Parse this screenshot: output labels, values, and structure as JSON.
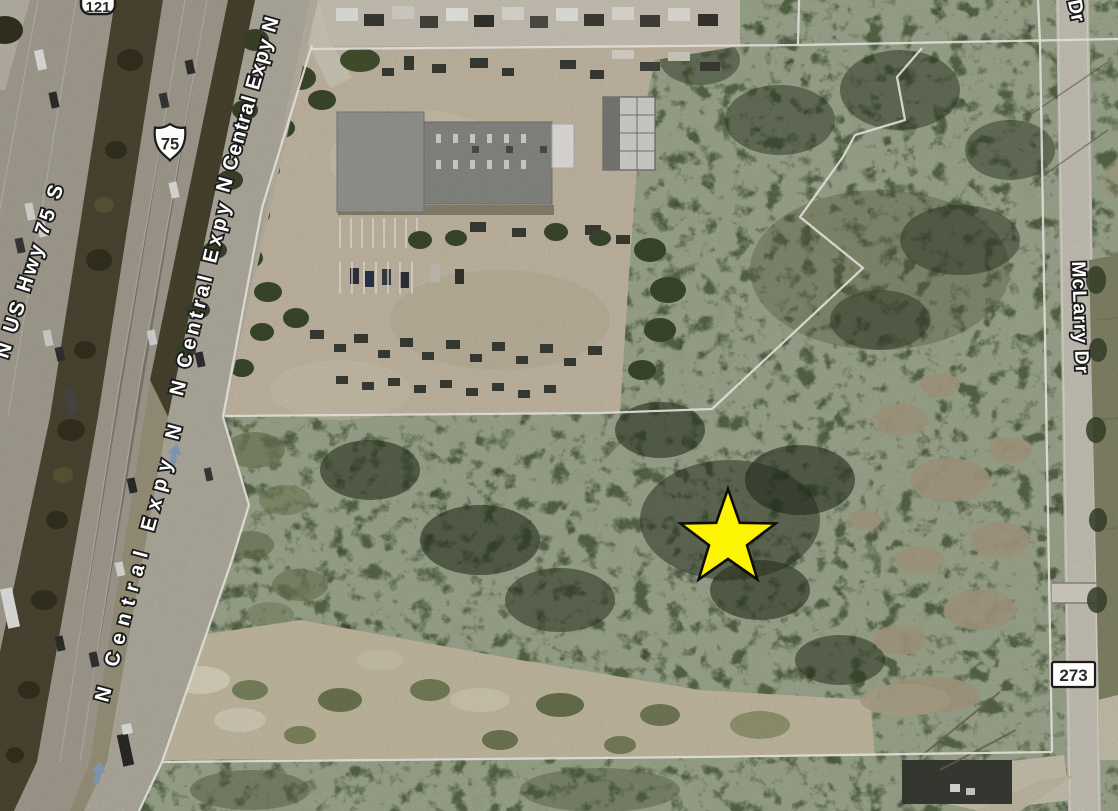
{
  "map": {
    "type": "satellite-aerial",
    "road_labels": [
      {
        "name": "n-us-hwy-75-s",
        "text": "N US Hwy 75 S"
      },
      {
        "name": "n-central-expy-n-upper",
        "text": "N Central Expy N"
      },
      {
        "name": "n-central-expy",
        "text": "N Central Expy"
      },
      {
        "name": "n-central-expy-n-lower",
        "text": "N Central Expy N"
      },
      {
        "name": "mclarry-dr",
        "text": "McLarry Dr"
      },
      {
        "name": "dr-partial",
        "text": "Dr"
      }
    ],
    "route_shields": [
      {
        "name": "sh-121",
        "text": "121",
        "style": "rounded-shield"
      },
      {
        "name": "us-75",
        "text": "75",
        "style": "us-route-shield"
      },
      {
        "name": "cr-273",
        "text": "273",
        "style": "rect-shield"
      }
    ],
    "marker": {
      "name": "location-star",
      "shape": "5-point-star",
      "fill": "#fcf400",
      "outline": "#0d0d0d"
    },
    "colors": {
      "trees": "#46513a",
      "yard_dirt": "#c8bda8",
      "highway_pavement": "#a9a396",
      "median_trees": "#4d4734",
      "frontage_road": "#b5b0a3",
      "parcel_line": "#f6f4ef",
      "clearing": "#c9bfa6",
      "mclarry_road": "#ccc7ba",
      "one_way_arrow": "#8ba3c2"
    }
  }
}
